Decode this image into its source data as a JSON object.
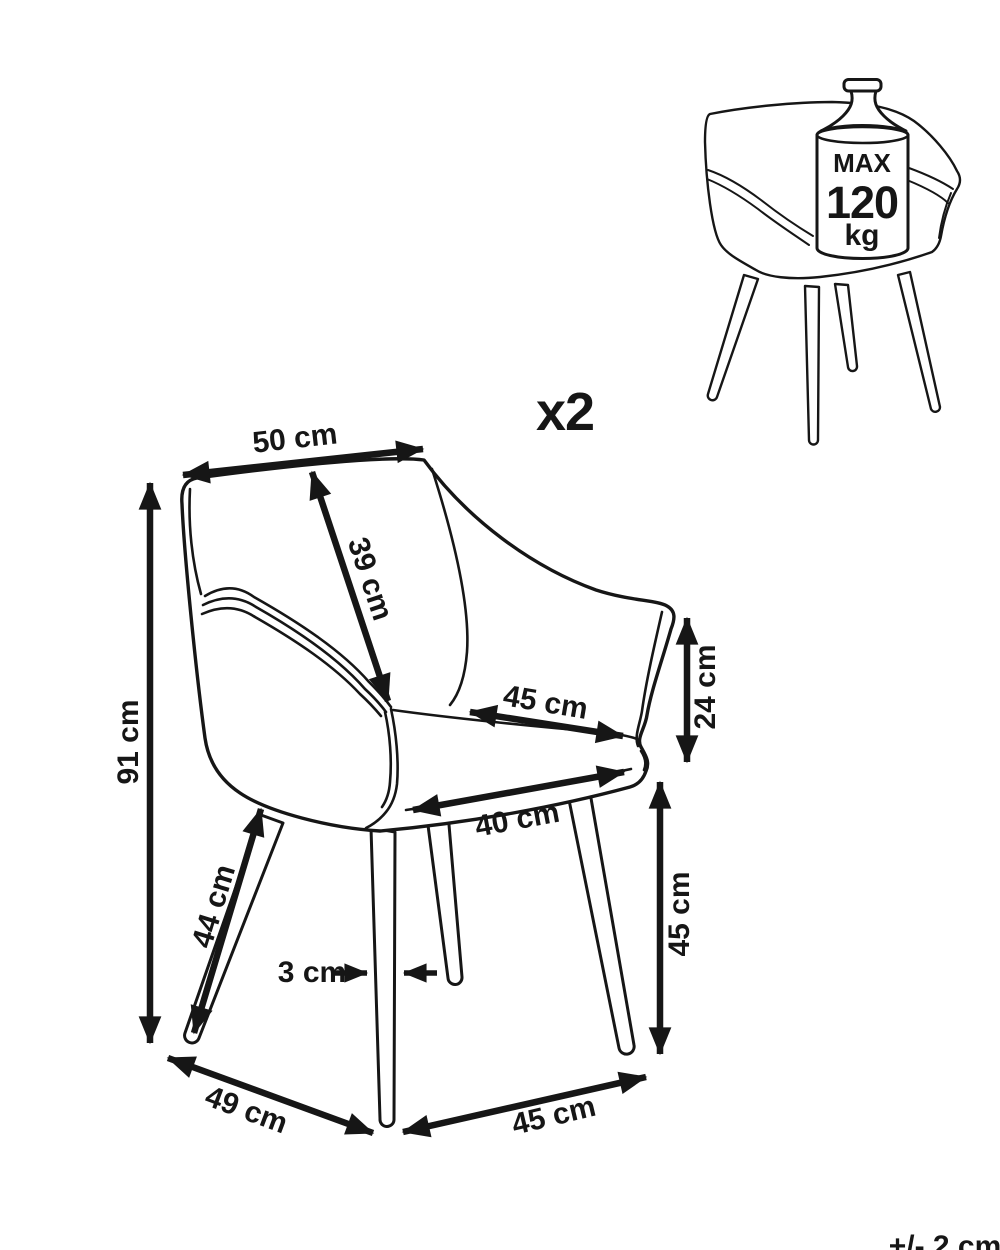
{
  "diagram": {
    "quantity": "x2",
    "tolerance": "+/- 2 cm",
    "weight_limit": {
      "max_label": "MAX",
      "value": "120",
      "unit": "kg"
    },
    "dimensions": {
      "top_width": "50 cm",
      "backrest_diagonal": "39 cm",
      "total_height": "91 cm",
      "seat_width": "45 cm",
      "armrest_height": "24 cm",
      "seat_depth": "40 cm",
      "front_leg_diagonal": "44 cm",
      "leg_thickness": "3 cm",
      "leg_height": "45 cm",
      "base_depth": "49 cm",
      "base_width": "45 cm"
    },
    "colors": {
      "ink": "#161616",
      "background": "#ffffff"
    }
  }
}
